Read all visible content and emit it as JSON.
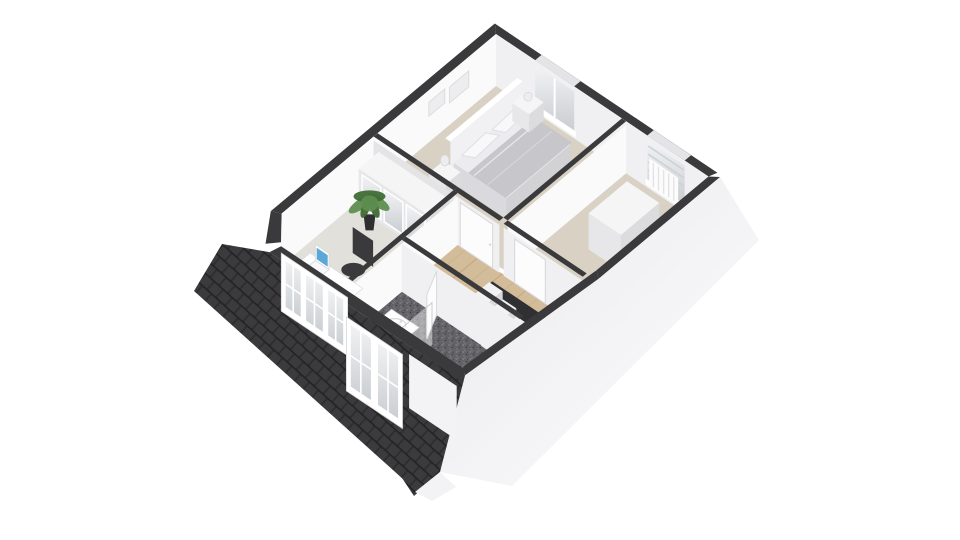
{
  "scene": {
    "type": "3d-floor-plan-render",
    "description": "Isometric dollhouse-style 3D floor plan of an attic storey viewed from the south-east, no text labels",
    "background": "#ffffff",
    "rooms": [
      {
        "name": "bedroom",
        "floor": "beige-carpet",
        "furniture": [
          "double-bed",
          "duvet",
          "pillow",
          "pillow",
          "headboard",
          "nightstand-left",
          "nightstand-right",
          "table-lamp",
          "table-lamp",
          "wall-frames",
          "window"
        ]
      },
      {
        "name": "office-bedroom-2",
        "floor": "light-carpet",
        "furniture": [
          "desk",
          "laptop",
          "office-chair",
          "wardrobe-glass-doors",
          "potted-plant",
          "dormer-windows"
        ]
      },
      {
        "name": "walk-through-room",
        "floor": "beige-carpet",
        "furniture": [
          "low-cabinet",
          "radiator",
          "window",
          "door"
        ]
      },
      {
        "name": "landing",
        "floor": "wood-planks",
        "furniture": [
          "staircase",
          "door"
        ]
      },
      {
        "name": "bathroom",
        "floor": "dark-terrazzo",
        "furniture": [
          "washbasin-vanity",
          "shower-glass",
          "door-ajar",
          "dormer-windows"
        ]
      }
    ],
    "exterior": {
      "roof_left": "dark-shingles",
      "roof_front_strip": "dark-shingles",
      "roof_right": "white-slope",
      "dormer_window_groups": 2,
      "gable": "white"
    }
  },
  "colors": {
    "bg": "#ffffff",
    "wallTop": "#3a3a3c",
    "wallFace": "#fafafa",
    "wallFaceShade": "#f0f0f2",
    "wallFaceDark": "#e4e4e7",
    "wallChamfer": "#f3f3f5",
    "floorBeige": "#d8d1c4",
    "floorOffice": "#e2e0da",
    "floorWood": "#d3bc99",
    "woodLine": "#bfa47d",
    "floorBathBase": "#636367",
    "speck1": "#8a8a8e",
    "speck2": "#3e3e42",
    "roofBase": "#2d2d2f",
    "shingle": "#3b3b3e",
    "shingleGap": "#1e1e20",
    "slopeA": "#e9e9ec",
    "slopeB": "#fdfdfe",
    "white": "#ffffff",
    "furnTop": "#f5f5f6",
    "furnFront": "#e7e7ea",
    "furnSide": "#dcdcdf",
    "headboard": "#f1f1f3",
    "mattress": "#ececee",
    "bedFoot": "#d2d2d5",
    "bedSide": "#dadade",
    "duvet": "#c7c7cb",
    "pillow": "#f8f8fa",
    "pillowEdge": "#e0e0e3",
    "glassA": "#f2f3f4",
    "glassB": "#c9cdd1",
    "mullion": "#ffffff",
    "green": "#5f8f50",
    "greenDark": "#3f6b35",
    "pot": "#2f2f31",
    "laptopBody": "#f7f8f9",
    "laptopScreen": "#5aa7d8",
    "chair": "#3a3a3d",
    "door": "#fcfcfd",
    "doorEdge": "#d8d8db",
    "stairTread": "#f2f2f4",
    "stairRiser": "#d9d9dc",
    "stairHole": "#303033",
    "sinkRim": "#d9dadc",
    "gable": "#f3f3f5",
    "frameGray": "#ededef",
    "radLine": "#e3e3e6",
    "blind": "#cfd2d5"
  }
}
